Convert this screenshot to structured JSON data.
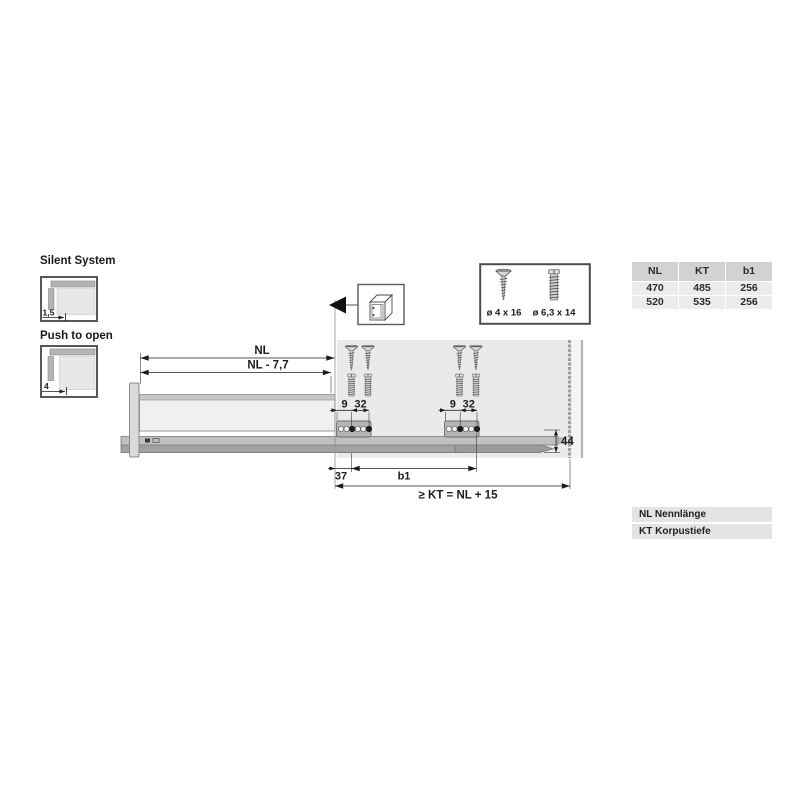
{
  "colors": {
    "cabinet_fill": "#eaeaea",
    "metal_gray": "#b5b5b5",
    "dimension_ink": "#1c1c1c",
    "table_header_bg": "#d2d2d2",
    "table_row_bg": "#ececec"
  },
  "features": {
    "silent_system": {
      "label": "Silent System",
      "dim": "1,5"
    },
    "push_to_open": {
      "label": "Push to open",
      "dim": "4"
    }
  },
  "screw_box": {
    "screw1": "ø 4 x 16",
    "screw2": "ø 6,3 x 14"
  },
  "size_table": {
    "headers": [
      "NL",
      "KT",
      "b1"
    ],
    "rows": [
      [
        "470",
        "485",
        "256"
      ],
      [
        "520",
        "535",
        "256"
      ]
    ]
  },
  "legend": {
    "items": [
      "NL Nennlänge",
      "KT Korpustiefe"
    ]
  },
  "dims": {
    "nl": "NL",
    "nl_minus": "NL - 7,7",
    "d9": "9",
    "d32": "32",
    "d44": "44",
    "d37": "37",
    "b1": "b1",
    "kt": "≥ KT = NL + 15"
  }
}
